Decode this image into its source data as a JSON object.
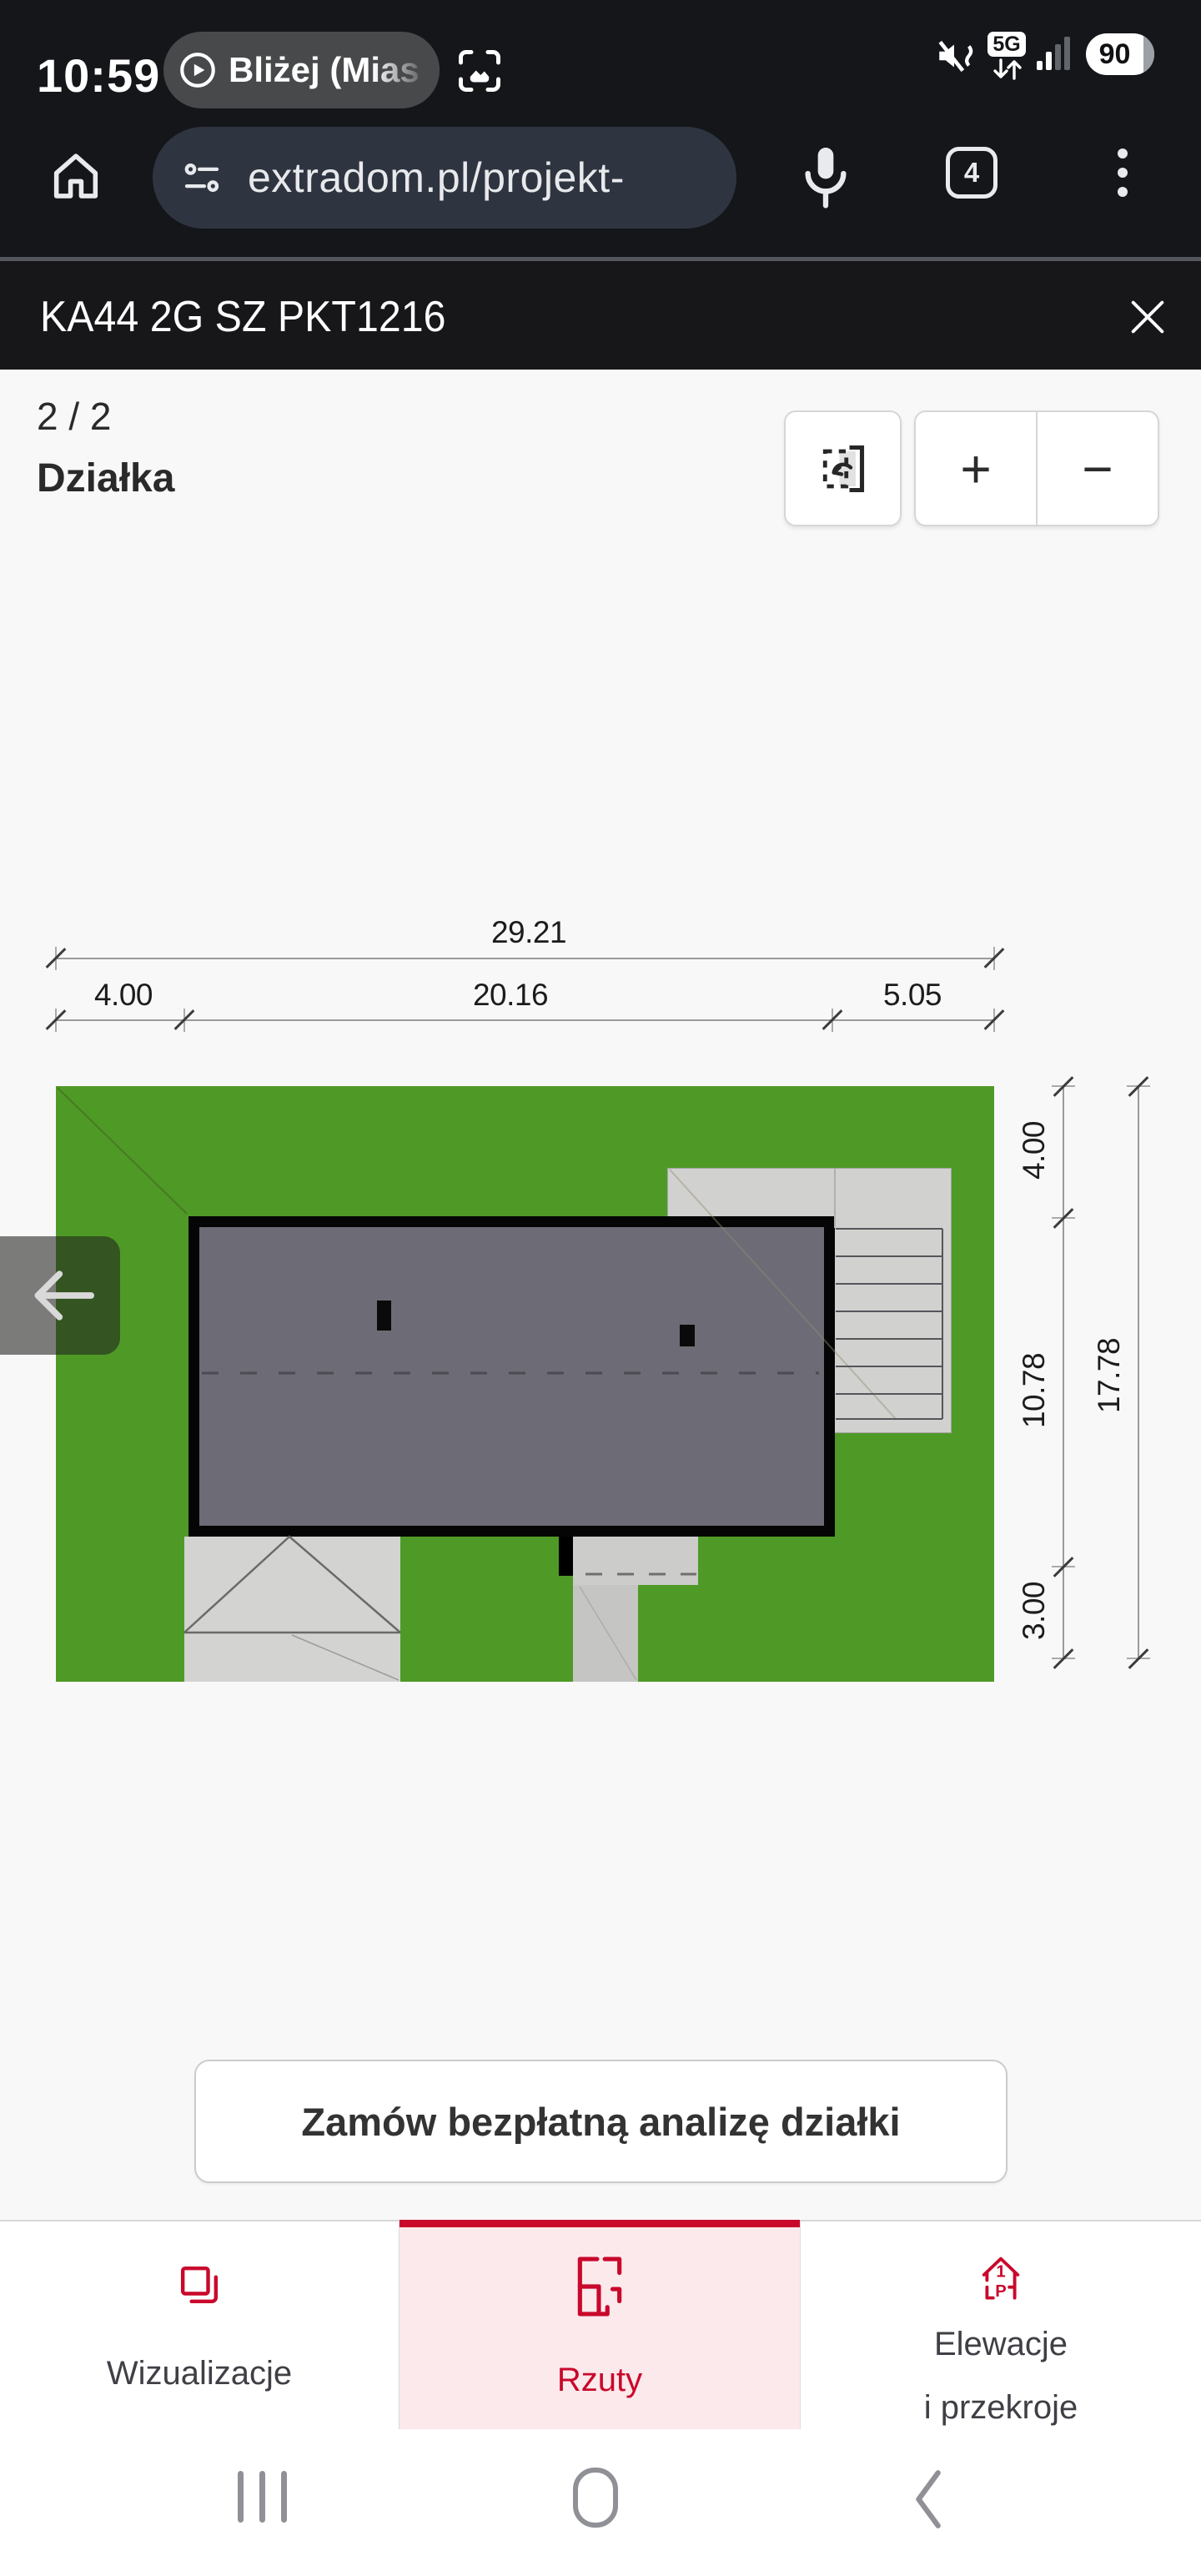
{
  "status_bar": {
    "time": "10:59",
    "media_pill": "Bliżej (Mias",
    "network_badge": "5G",
    "battery_level": "90"
  },
  "browser_bar": {
    "url": "extradom.pl/projekt-",
    "tab_count": "4"
  },
  "project_header": {
    "title": "KA44 2G SZ PKT1216"
  },
  "viewer": {
    "page_indicator": "2 / 2",
    "view_title": "Działka",
    "zoom_in": "+",
    "zoom_out": "−"
  },
  "site_plan": {
    "width_total": "29.21",
    "width_segments": [
      "4.00",
      "20.16",
      "5.05"
    ],
    "height_total": "17.78",
    "height_segments": [
      "4.00",
      "10.78",
      "3.00"
    ],
    "colors": {
      "lawn": "#4f9a26",
      "roof": "#6c6b76",
      "paving": "#d1d1cf",
      "accent_red": "#c9082c"
    }
  },
  "cta": {
    "label": "Zamów bezpłatną analizę działki"
  },
  "tab_bar": {
    "tabs": [
      {
        "label": "Wizualizacje"
      },
      {
        "label": "Rzuty",
        "active": true
      },
      {
        "label": "Elewacje",
        "label2": "i przekroje",
        "icon_text_1": "1",
        "icon_text_2": "P"
      }
    ]
  }
}
